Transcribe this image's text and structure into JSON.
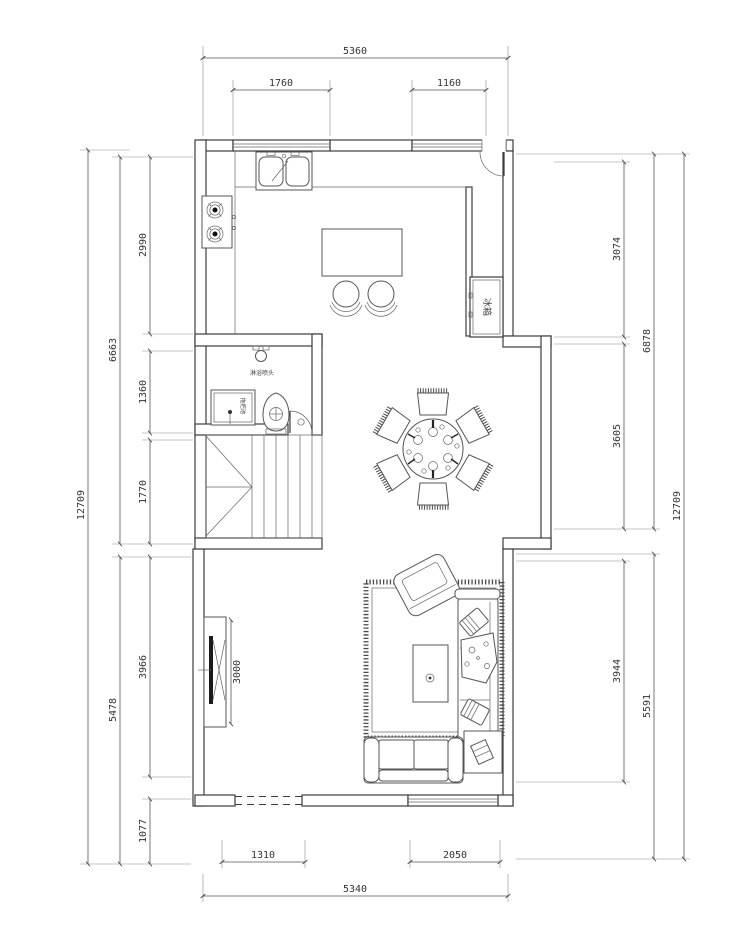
{
  "plan": {
    "title": "residential-floor-plan",
    "dims": {
      "top": {
        "total": "5360",
        "window_left": "1760",
        "window_right": "1160"
      },
      "bottom": {
        "opening": "1310",
        "window": "2050",
        "total": "5340"
      },
      "left": {
        "outer": "12709",
        "mid_upper": "6663",
        "mid_lower": "5478",
        "inner": [
          "2990",
          "1360",
          "1770",
          "3966",
          "1077"
        ]
      },
      "right": {
        "inner": [
          "3074",
          "3605",
          "3944"
        ],
        "mid_upper": "6878",
        "mid_lower": "5591",
        "outer": "12709"
      },
      "tv_wall": "3000"
    },
    "labels": {
      "fridge": "冰箱",
      "shower": "淋浴喷头",
      "mop_pool": "拖把池"
    },
    "colors": {
      "line": "#3c3c3c",
      "dim": "#555555",
      "text": "#333333"
    }
  }
}
